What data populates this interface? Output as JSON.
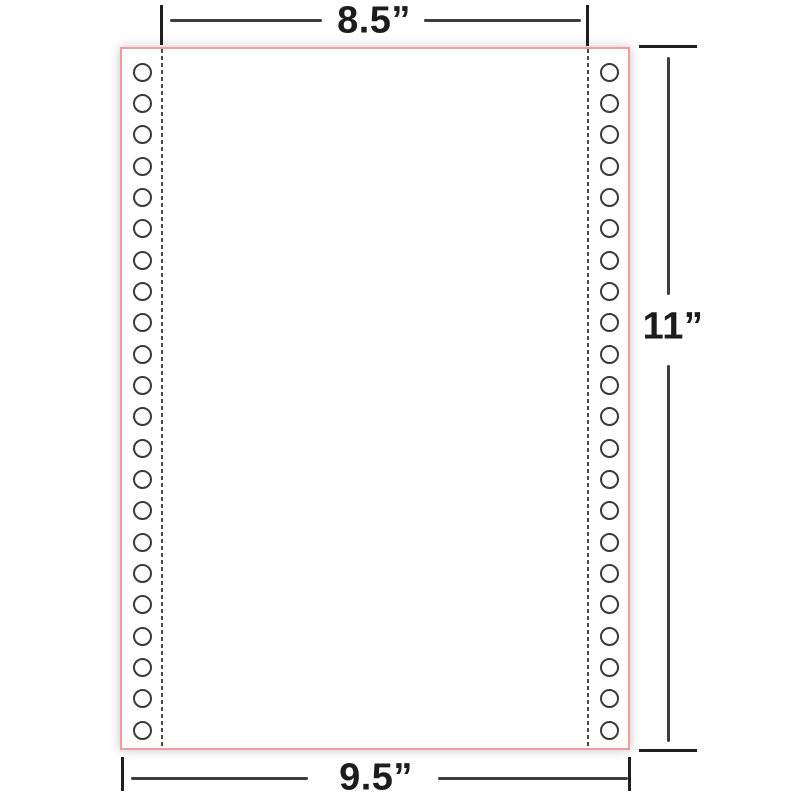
{
  "diagram": {
    "name": "continuous-form-paper-dimensions",
    "labels": {
      "top_width": "8.5”",
      "bottom_width": "9.5”",
      "sheet_height": "11”"
    },
    "colors": {
      "paper_fill": "#ffffff",
      "paper_border": "#f29d9d",
      "perforation": "#4a4a4a",
      "hole_ring": "#3a3a3a",
      "annotation": "#3d3d3d",
      "label_text": "#1c1c1c"
    },
    "holes": {
      "per_column": 22,
      "columns": 2
    }
  }
}
